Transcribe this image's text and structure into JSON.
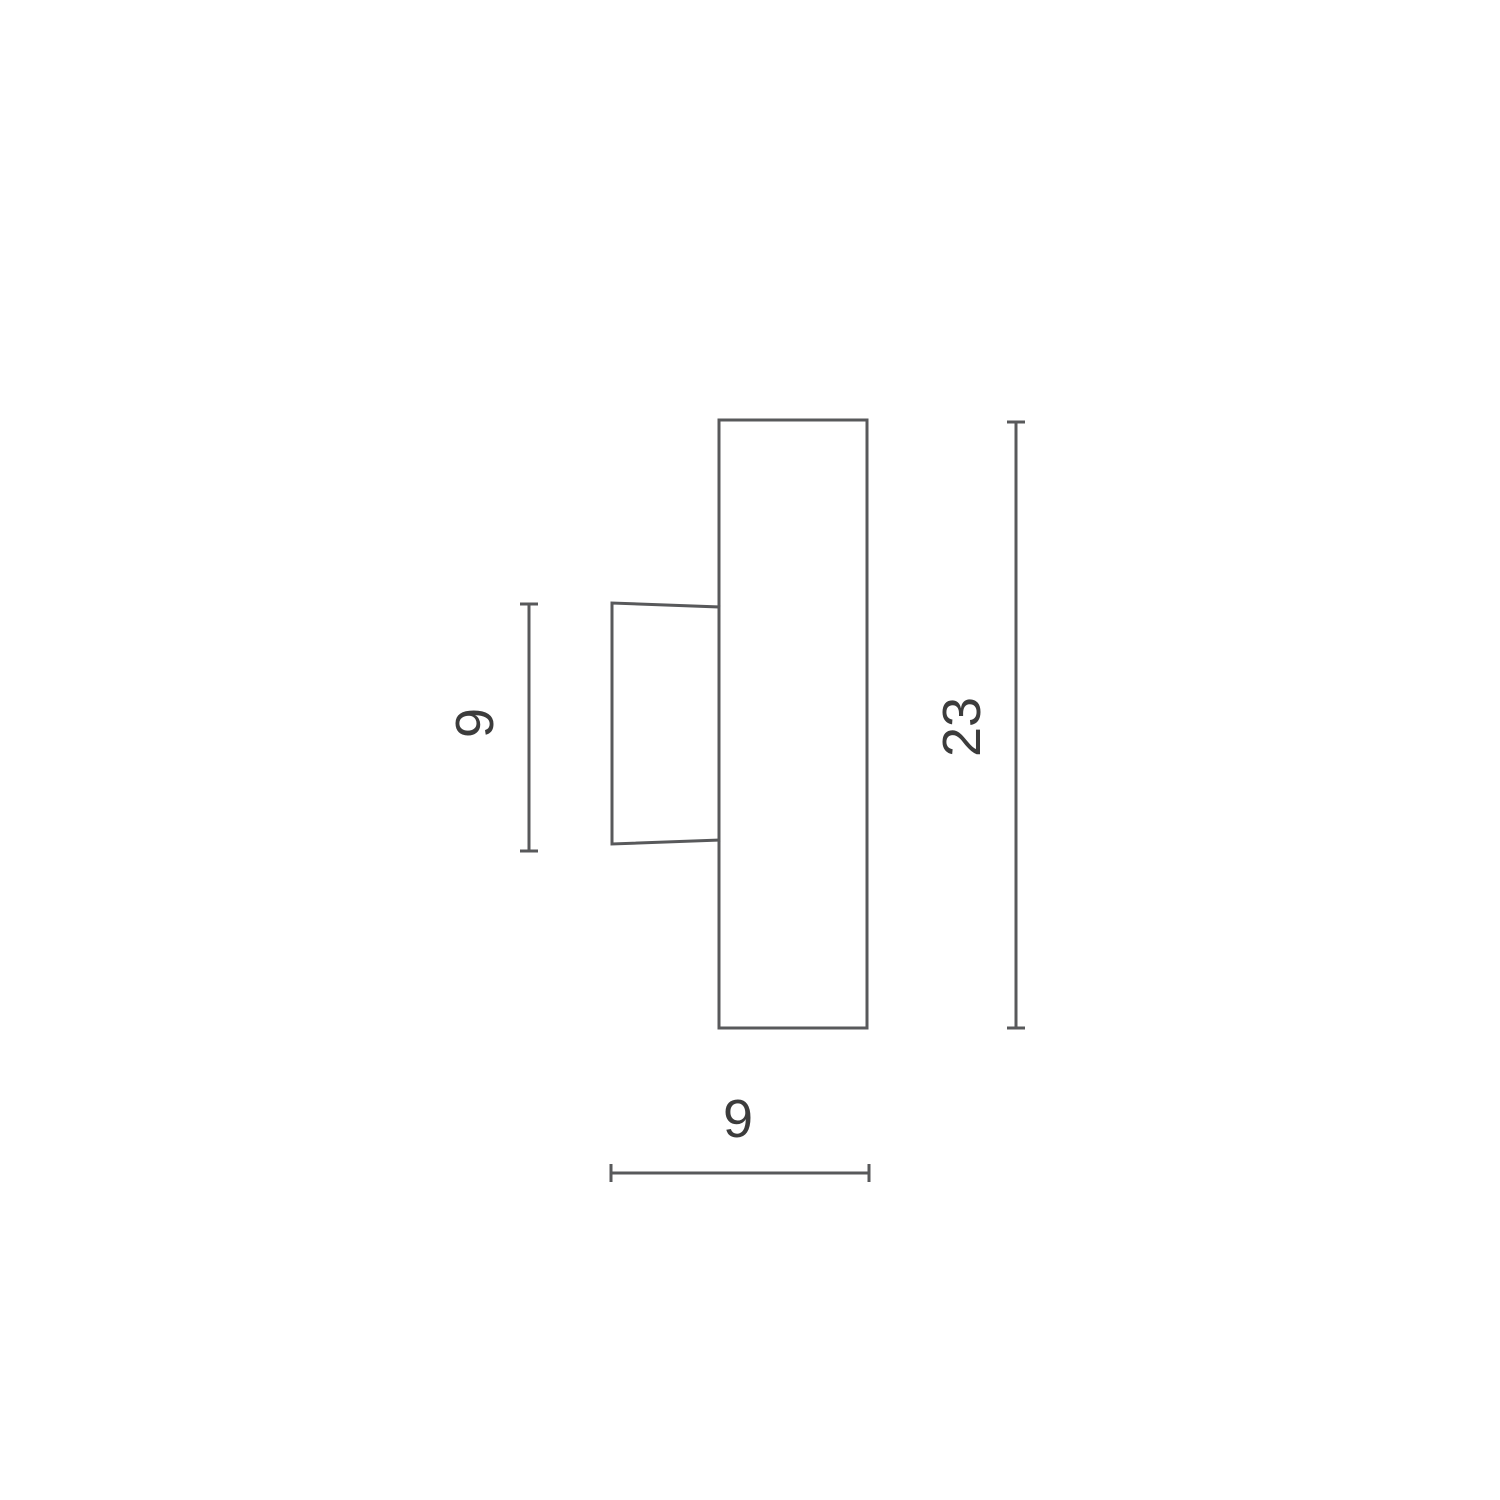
{
  "drawing": {
    "type": "technical-dimension-diagram",
    "subject": "wall-light-side-view",
    "background_color": "#ffffff",
    "line_color": "#58595b",
    "text_color": "#3c3c3c",
    "dimensions": {
      "bracket_height": {
        "label": "9",
        "orientation": "vertical",
        "side": "left"
      },
      "overall_height": {
        "label": "23",
        "orientation": "vertical",
        "side": "right"
      },
      "overall_depth": {
        "label": "9",
        "orientation": "horizontal",
        "side": "bottom"
      }
    }
  }
}
